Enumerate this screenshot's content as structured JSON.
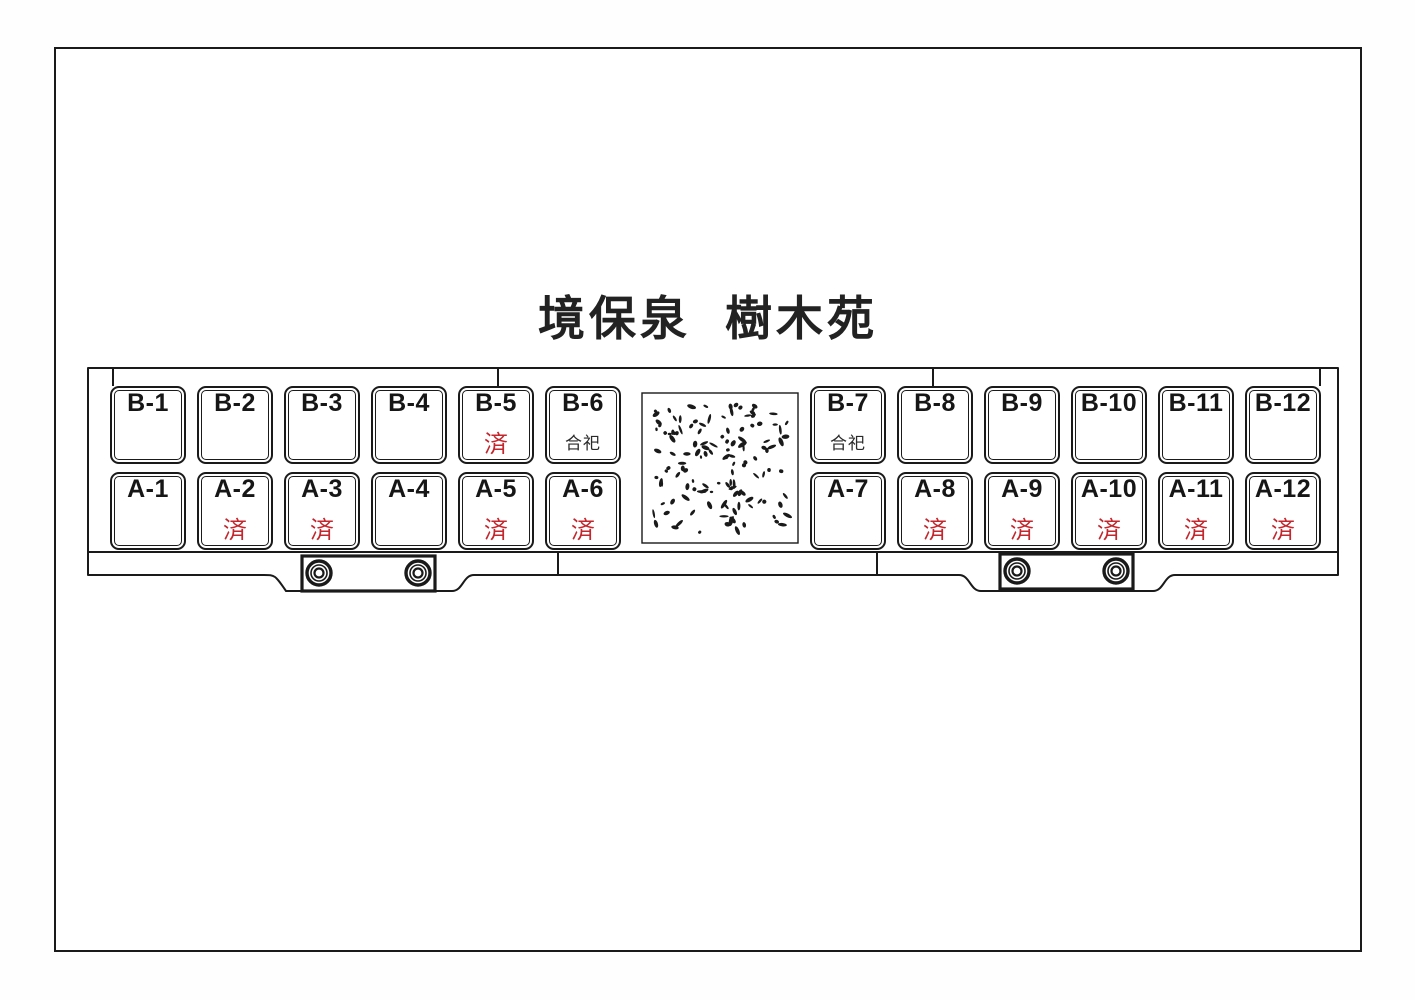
{
  "title": "境保泉  樹木苑",
  "colors": {
    "line": "#1a1a1a",
    "reserved_red": "#c3262c",
    "background": "#ffffff"
  },
  "status_labels": {
    "reserved": "済",
    "communal": "合祀"
  },
  "rows": [
    {
      "id": "B",
      "plots": [
        {
          "label": "B-1",
          "status": "",
          "status_type": ""
        },
        {
          "label": "B-2",
          "status": "",
          "status_type": ""
        },
        {
          "label": "B-3",
          "status": "",
          "status_type": ""
        },
        {
          "label": "B-4",
          "status": "",
          "status_type": ""
        },
        {
          "label": "B-5",
          "status": "済",
          "status_type": "reserved"
        },
        {
          "label": "B-6",
          "status": "合祀",
          "status_type": "communal"
        },
        {
          "label": "B-7",
          "status": "合祀",
          "status_type": "communal"
        },
        {
          "label": "B-8",
          "status": "",
          "status_type": ""
        },
        {
          "label": "B-9",
          "status": "",
          "status_type": ""
        },
        {
          "label": "B-10",
          "status": "",
          "status_type": ""
        },
        {
          "label": "B-11",
          "status": "",
          "status_type": ""
        },
        {
          "label": "B-12",
          "status": "",
          "status_type": ""
        }
      ]
    },
    {
      "id": "A",
      "plots": [
        {
          "label": "A-1",
          "status": "",
          "status_type": ""
        },
        {
          "label": "A-2",
          "status": "済",
          "status_type": "reserved"
        },
        {
          "label": "A-3",
          "status": "済",
          "status_type": "reserved"
        },
        {
          "label": "A-4",
          "status": "",
          "status_type": ""
        },
        {
          "label": "A-5",
          "status": "済",
          "status_type": "reserved"
        },
        {
          "label": "A-6",
          "status": "済",
          "status_type": "reserved"
        },
        {
          "label": "A-7",
          "status": "",
          "status_type": ""
        },
        {
          "label": "A-8",
          "status": "済",
          "status_type": "reserved"
        },
        {
          "label": "A-9",
          "status": "済",
          "status_type": "reserved"
        },
        {
          "label": "A-10",
          "status": "済",
          "status_type": "reserved"
        },
        {
          "label": "A-11",
          "status": "済",
          "status_type": "reserved"
        },
        {
          "label": "A-12",
          "status": "済",
          "status_type": "reserved"
        }
      ]
    }
  ]
}
